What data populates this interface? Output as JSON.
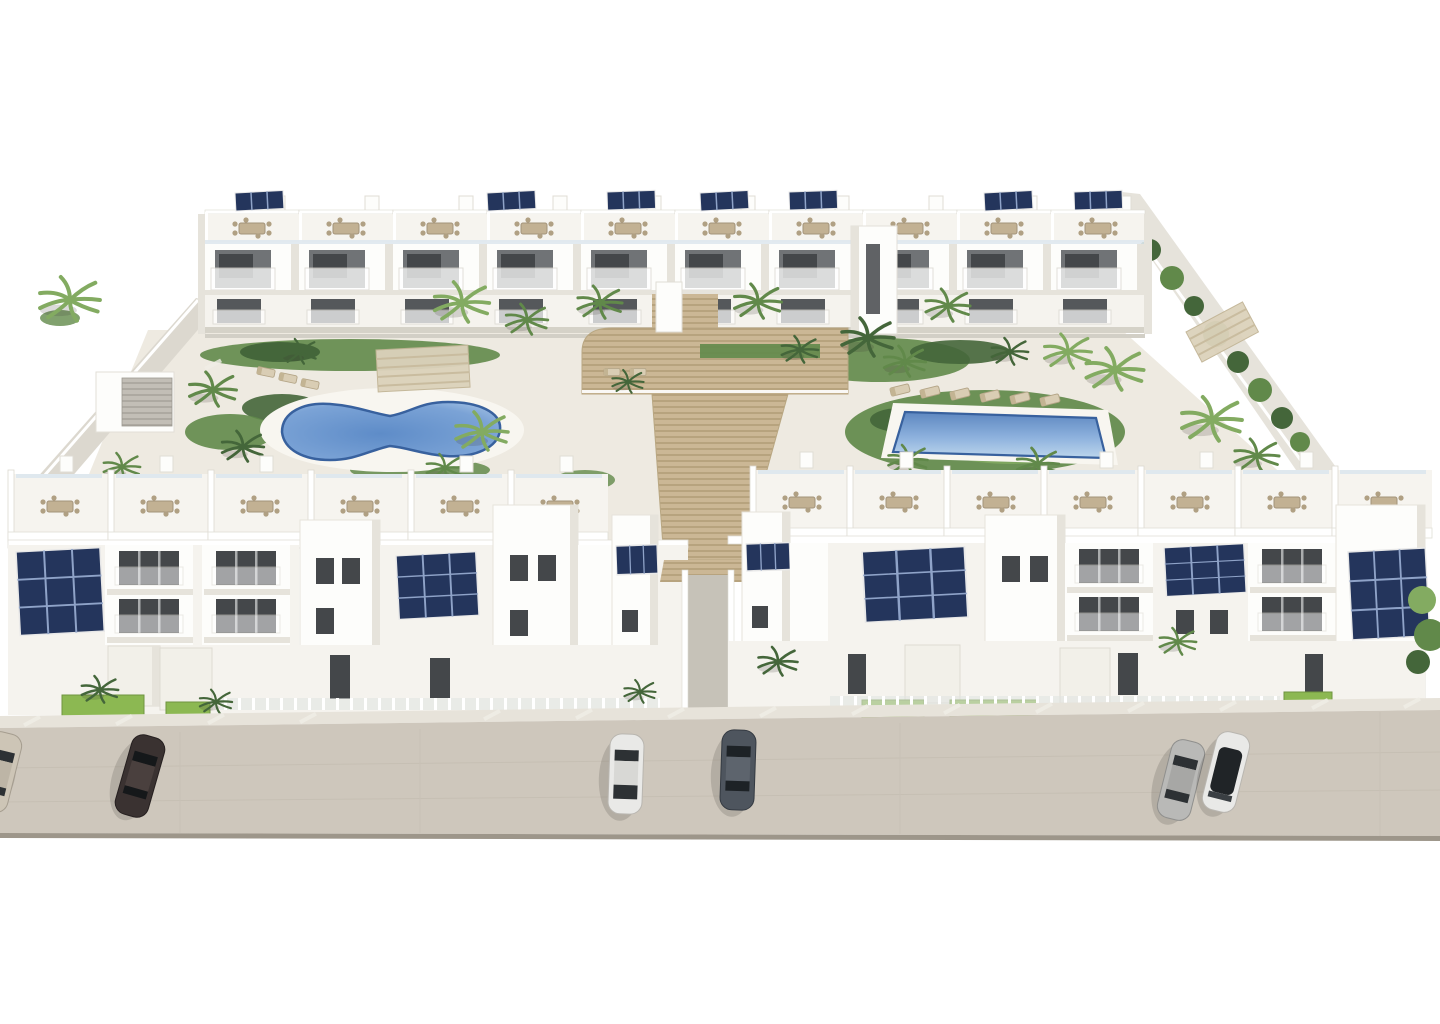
{
  "scene": {
    "type": "3d-architectural-rendering",
    "view": "aerial front view, white background",
    "subject": "Modern white Mediterranean apartment complex with landscaped courtyard, two swimming pools, curved timber amphitheater stairs, palm garden, rooftop solar panels, roof terraces and a street with parked cars in the foreground",
    "regions": {
      "rear_block": "long three-storey apartment row with roof terraces, dining sets, glass balconies and solar panels",
      "front_blocks": "two three-storey blocks separated by a central passage, rooftop terraces with dining sets, solar arrays, private ground-floor lawns with fences and garages",
      "courtyard": "gardens with palm trees, kidney-shaped pool (left), rectangular pool (right), sun loungers and pergolas",
      "amphitheater_stairs": "wide slatted timber steps descending from the rear block to the central passage",
      "perimeter": "white and grey boundary walls with hedges on left and right",
      "street": "beige asphalt road with striped sidewalk and six parked cars"
    }
  },
  "counts": {
    "pools": 2,
    "parked_cars": 6,
    "palm_trees": 28,
    "solar_panel_arrays": 14,
    "rear_apartment_modules": 10,
    "front_roof_terraces": 13,
    "sun_loungers": 11
  },
  "colors": {
    "bg": "#ffffff",
    "wall_white": "#fdfdfb",
    "wall_light": "#f5f3ee",
    "wall_shade": "#e6e3db",
    "wall_dark_shade": "#d5d2c8",
    "window_dark": "#44474a",
    "window_mid": "#707376",
    "glass_rail": "#dfe8ee",
    "terrace_floor": "#f6f4ef",
    "furniture_beige": "#c2b193",
    "furniture_dark": "#9a8a6d",
    "deck_wood": "#cbb795",
    "deck_slat": "#b29e79",
    "solar_blue": "#24355c",
    "solar_line": "#8fa3c8",
    "pool_water_deep": "#5e8cc8",
    "pool_water_light": "#bdd6ec",
    "pool_edge": "#38619e",
    "pool_coping": "#f8f6f0",
    "courtyard": "#eeeae1",
    "grass_bright": "#8cb852",
    "green_dark": "#44663a",
    "green_mid": "#61894a",
    "green_light": "#83ab61",
    "street": "#cec7bc",
    "street_edge": "#9d968a",
    "sidewalk": "#e7e3da",
    "curb": "#c2bcb0",
    "car_dark_brown": "#3a3231",
    "car_white": "#e9e9e7",
    "car_silver": "#b9b9b7",
    "car_slate": "#4e555e",
    "car_beige": "#cdc5b6",
    "car_glass": "#2d3134",
    "shadow": "rgba(60,58,50,0.18)"
  }
}
